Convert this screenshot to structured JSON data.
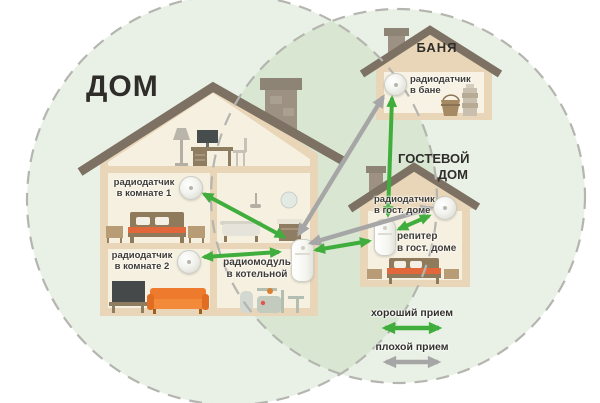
{
  "titles": {
    "main_house": "ДОМ",
    "bathhouse": "БАНЯ",
    "guest_house": "ГОСТЕВОЙ\nДОМ"
  },
  "labels": {
    "sensor_room1": "радиодатчик\nв комнате 1",
    "sensor_room2": "радиодатчик\nв комнате 2",
    "radio_module": "радиомодуль\nв котельной",
    "sensor_bathhouse": "радиодатчик\nв бане",
    "sensor_guesthouse": "радиодатчик\nв гост. доме",
    "repeater_guesthouse": "репитер\nв гост. доме"
  },
  "legend": {
    "good_signal": "хороший прием",
    "bad_signal": "плохой прием"
  },
  "colors": {
    "good_signal": "#3fae3c",
    "bad_signal": "#a6a6a6",
    "coverage_fill": "#9cbf8e",
    "coverage_stroke": "#b5b5b0",
    "roof": "#7d7163",
    "wall_frame": "#e9d6b8",
    "wall_interior": "#f6f0e0",
    "sofa_orange": "#ee7b2d"
  }
}
